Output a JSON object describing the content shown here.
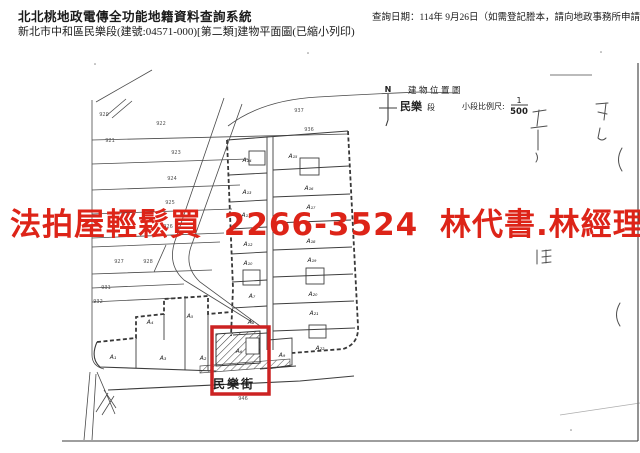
{
  "header": {
    "system_title": "北北桃地政電傳全功能地籍資料查詢系統",
    "doc_line": "新北市中和區民樂段(建號:04571-000)[第二類]建物平面圖(已縮小列印)",
    "query_date": "查詢日期：114年 9月26日（如需登記謄本，請向地政事務所申請。）"
  },
  "watermark": {
    "text": "法拍屋輕鬆買 2266-3524 林代書.林經理",
    "color": "#dd2418"
  },
  "highlight_color": "#cc2222",
  "legend": {
    "north": "N",
    "map_title": "建物位置圖",
    "section_bold": "民樂",
    "section_rest": "段",
    "scale_label": "小段比例尺:",
    "scale_num": "1",
    "scale_den": "500"
  },
  "street": {
    "name": "民樂街",
    "number": "946"
  },
  "plan": {
    "unit_labels": [
      {
        "t": "A₁₄",
        "x": 247,
        "y": 162
      },
      {
        "t": "A₁₃",
        "x": 247,
        "y": 194
      },
      {
        "t": "A₁₁",
        "x": 246,
        "y": 217
      },
      {
        "t": "A₁₂",
        "x": 248,
        "y": 246
      },
      {
        "t": "A₁₀",
        "x": 248,
        "y": 265
      },
      {
        "t": "A₇",
        "x": 252,
        "y": 298
      },
      {
        "t": "A₈",
        "x": 251,
        "y": 324
      },
      {
        "t": "A₁₅",
        "x": 293,
        "y": 158
      },
      {
        "t": "A₁₆",
        "x": 309,
        "y": 190
      },
      {
        "t": "A₁₇",
        "x": 311,
        "y": 209
      },
      {
        "t": "A₁₈",
        "x": 311,
        "y": 243
      },
      {
        "t": "A₁₉",
        "x": 312,
        "y": 262
      },
      {
        "t": "A₂₀",
        "x": 313,
        "y": 296
      },
      {
        "t": "A₂₁",
        "x": 314,
        "y": 315
      },
      {
        "t": "A₂₂",
        "x": 320,
        "y": 350
      },
      {
        "t": "A₁",
        "x": 113,
        "y": 359
      },
      {
        "t": "A₄",
        "x": 150,
        "y": 324
      },
      {
        "t": "A₃",
        "x": 163,
        "y": 360
      },
      {
        "t": "A₅",
        "x": 190,
        "y": 318
      },
      {
        "t": "A₂",
        "x": 203,
        "y": 360
      },
      {
        "t": "A₆",
        "x": 239,
        "y": 353
      },
      {
        "t": "A₉",
        "x": 282,
        "y": 357
      }
    ],
    "lot_labels": [
      {
        "t": "920",
        "x": 104,
        "y": 116
      },
      {
        "t": "921",
        "x": 110,
        "y": 142
      },
      {
        "t": "922",
        "x": 161,
        "y": 125
      },
      {
        "t": "937",
        "x": 299,
        "y": 112
      },
      {
        "t": "936",
        "x": 309,
        "y": 131
      },
      {
        "t": "923",
        "x": 176,
        "y": 154
      },
      {
        "t": "924",
        "x": 172,
        "y": 180
      },
      {
        "t": "925",
        "x": 170,
        "y": 204
      },
      {
        "t": "926",
        "x": 168,
        "y": 228
      },
      {
        "t": "927",
        "x": 119,
        "y": 263
      },
      {
        "t": "928",
        "x": 148,
        "y": 263
      },
      {
        "t": "931",
        "x": 106,
        "y": 289
      },
      {
        "t": "932",
        "x": 98,
        "y": 303
      }
    ]
  }
}
